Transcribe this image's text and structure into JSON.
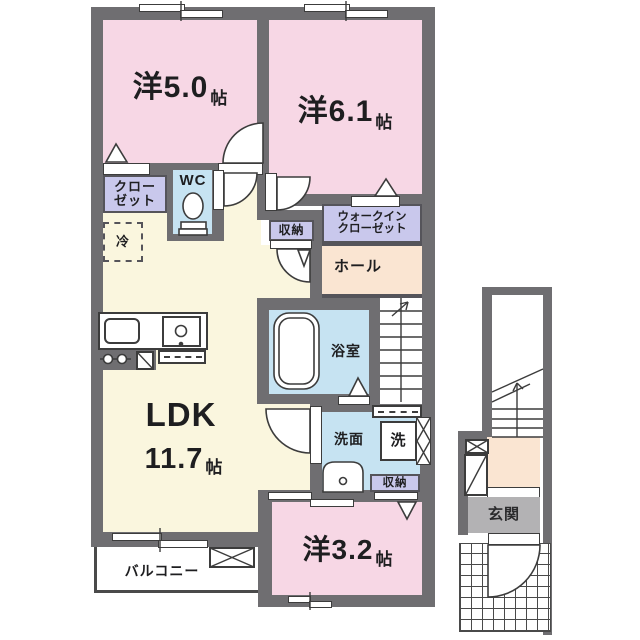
{
  "floorplan": {
    "kind": "apartment-floor-plan",
    "palette": {
      "wall": "#6f6e71",
      "room_pink": "#f7d7e5",
      "ldk_cream": "#faf6de",
      "wet_blue": "#c6e3f2",
      "storage_purple": "#c9c8ec",
      "hall_peach": "#fae5d2",
      "entrance_gray": "#b3b2b4",
      "line": "#3c3c3c"
    },
    "rooms": {
      "bedroom1": {
        "name": "洋5.0",
        "unit": "帖"
      },
      "bedroom2": {
        "name": "洋6.1",
        "unit": "帖"
      },
      "bedroom3": {
        "name": "洋3.2",
        "unit": "帖"
      },
      "ldk": {
        "name": "LDK",
        "size": "11.7",
        "unit": "帖"
      },
      "closet": {
        "line1": "クロー",
        "line2": "ゼット"
      },
      "wc": {
        "label": "WC"
      },
      "fridge": {
        "label": "冷"
      },
      "storage_mid": {
        "label": "収納"
      },
      "walk_in_closet": {
        "line1": "ウォークイン",
        "line2": "クローゼット"
      },
      "hall": {
        "label": "ホール"
      },
      "bath": {
        "label": "浴室"
      },
      "washroom": {
        "label": "洗面"
      },
      "washer": {
        "label": "洗"
      },
      "storage_low": {
        "label": "収納"
      },
      "balcony": {
        "label": "バルコニー"
      },
      "entrance": {
        "label": "玄関"
      }
    }
  }
}
